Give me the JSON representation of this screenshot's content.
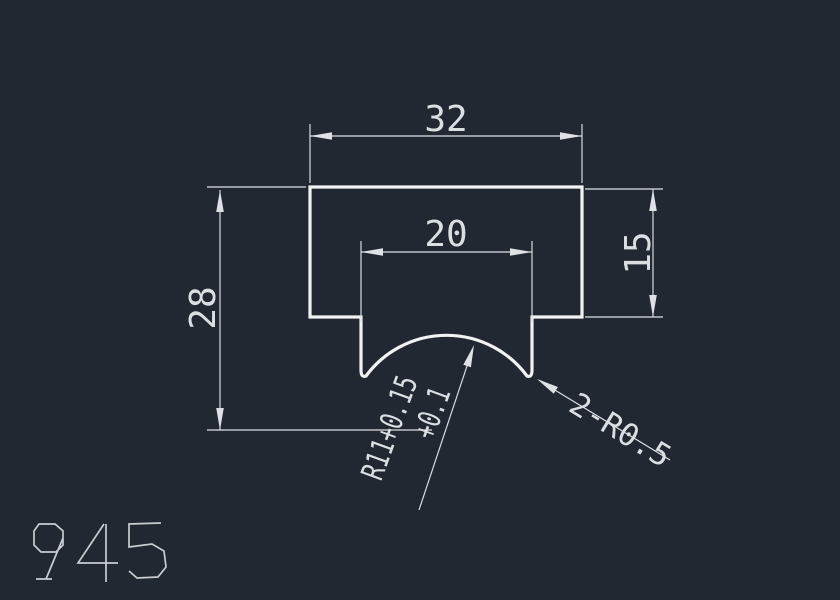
{
  "colors": {
    "background": "#222831",
    "profile_line": "#f1f2f4",
    "dimension_line": "#dfe2e5",
    "text": "#dbdfe2",
    "part_number": "#c9cdd1"
  },
  "drawing": {
    "part_number": "945",
    "dimensions": {
      "top_width": "32",
      "groove_width": "20",
      "right_height": "15",
      "left_height": "28"
    },
    "annotations": {
      "groove_radius_line1": "R11+0.15",
      "groove_radius_line2": "+0.1",
      "corner_fillets": "2-R0.5"
    }
  }
}
